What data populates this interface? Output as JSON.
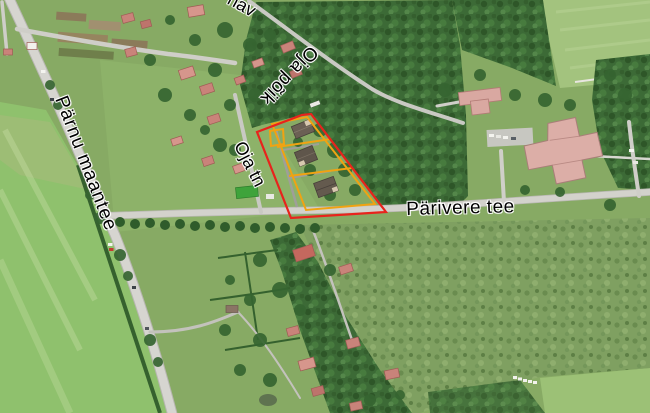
{
  "app": {
    "type": "aerial-orthophoto-map-view"
  },
  "map": {
    "street_labels": {
      "parnu_maantee": "Pärnu maantee",
      "parivere_tee": "Pärivere tee",
      "oja_poik": "Oja põik",
      "oja_tn": "Oja tn",
      "partial_top": "nav"
    },
    "overlay": {
      "selected_parcel_color": "#e8231c",
      "cadastral_parcel_color": "#f0a312"
    },
    "label_style": {
      "text_color": "#000000",
      "halo_color": "#ffffff"
    }
  }
}
